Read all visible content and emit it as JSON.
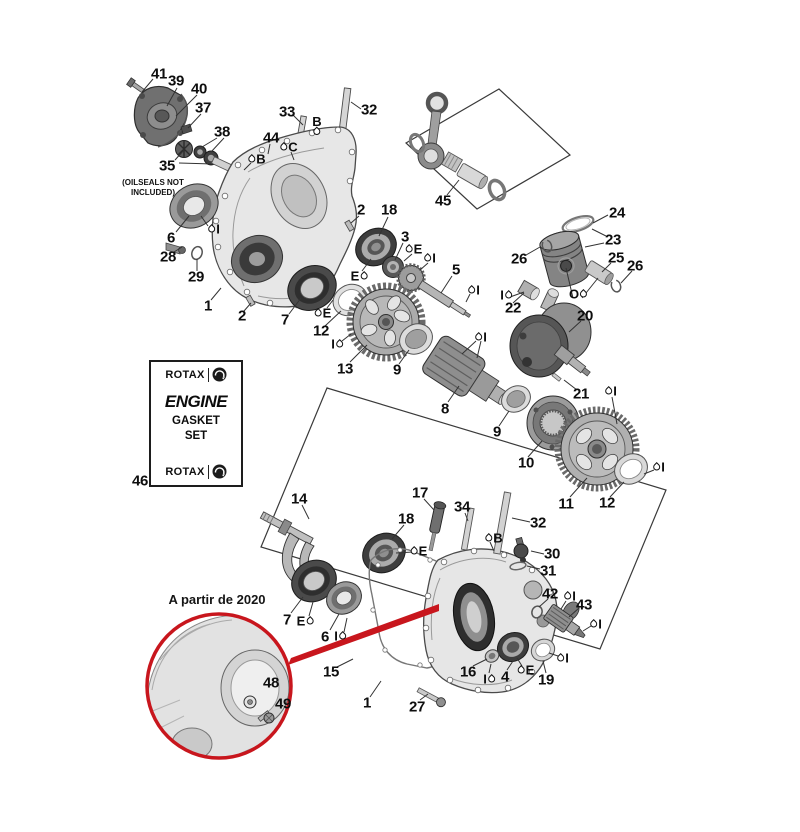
{
  "notes": {
    "oilseals_line1": "(OILSEALS NOT",
    "oilseals_line2": "INCLUDED)",
    "year_note": "A partir de 2020"
  },
  "gasket_kit": {
    "brand": "ROTAX",
    "product_line1": "ENGINE",
    "product_line2": "GASKET",
    "product_line3": "SET"
  },
  "colors": {
    "highlight_red": "#c8161d",
    "line": "#333333",
    "part_light": "#e6e6e6",
    "part_mid": "#9a9a9a",
    "part_dark": "#3d3d3d"
  },
  "part_labels": [
    {
      "n": "41",
      "x": 159,
      "y": 74
    },
    {
      "n": "39",
      "x": 176,
      "y": 81
    },
    {
      "n": "40",
      "x": 199,
      "y": 89
    },
    {
      "n": "37",
      "x": 203,
      "y": 108
    },
    {
      "n": "38",
      "x": 222,
      "y": 132
    },
    {
      "n": "33",
      "x": 287,
      "y": 112
    },
    {
      "n": "32",
      "x": 369,
      "y": 110
    },
    {
      "n": "44",
      "x": 271,
      "y": 138
    },
    {
      "n": "35",
      "x": 167,
      "y": 166
    },
    {
      "n": "6",
      "x": 171,
      "y": 238
    },
    {
      "n": "28",
      "x": 168,
      "y": 257
    },
    {
      "n": "29",
      "x": 196,
      "y": 277
    },
    {
      "n": "1",
      "x": 208,
      "y": 306
    },
    {
      "n": "2",
      "x": 361,
      "y": 210
    },
    {
      "n": "2",
      "x": 242,
      "y": 316
    },
    {
      "n": "18",
      "x": 389,
      "y": 210
    },
    {
      "n": "3",
      "x": 405,
      "y": 237
    },
    {
      "n": "45",
      "x": 443,
      "y": 201
    },
    {
      "n": "5",
      "x": 456,
      "y": 270
    },
    {
      "n": "24",
      "x": 617,
      "y": 213
    },
    {
      "n": "23",
      "x": 613,
      "y": 240
    },
    {
      "n": "26",
      "x": 519,
      "y": 259
    },
    {
      "n": "25",
      "x": 616,
      "y": 258
    },
    {
      "n": "26",
      "x": 635,
      "y": 266
    },
    {
      "n": "22",
      "x": 513,
      "y": 308
    },
    {
      "n": "20",
      "x": 585,
      "y": 316
    },
    {
      "n": "7",
      "x": 285,
      "y": 320
    },
    {
      "n": "12",
      "x": 321,
      "y": 331
    },
    {
      "n": "13",
      "x": 345,
      "y": 369
    },
    {
      "n": "9",
      "x": 397,
      "y": 370
    },
    {
      "n": "8",
      "x": 445,
      "y": 409
    },
    {
      "n": "9",
      "x": 497,
      "y": 432
    },
    {
      "n": "10",
      "x": 526,
      "y": 463
    },
    {
      "n": "21",
      "x": 581,
      "y": 394
    },
    {
      "n": "11",
      "x": 566,
      "y": 504
    },
    {
      "n": "12",
      "x": 607,
      "y": 503
    },
    {
      "n": "14",
      "x": 299,
      "y": 499
    },
    {
      "n": "17",
      "x": 420,
      "y": 493
    },
    {
      "n": "34",
      "x": 462,
      "y": 507
    },
    {
      "n": "32",
      "x": 538,
      "y": 523
    },
    {
      "n": "18",
      "x": 406,
      "y": 519
    },
    {
      "n": "30",
      "x": 552,
      "y": 554
    },
    {
      "n": "31",
      "x": 548,
      "y": 571
    },
    {
      "n": "42",
      "x": 550,
      "y": 594
    },
    {
      "n": "43",
      "x": 584,
      "y": 605
    },
    {
      "n": "7",
      "x": 287,
      "y": 620
    },
    {
      "n": "6",
      "x": 325,
      "y": 637
    },
    {
      "n": "15",
      "x": 331,
      "y": 672
    },
    {
      "n": "1",
      "x": 367,
      "y": 703
    },
    {
      "n": "27",
      "x": 417,
      "y": 707
    },
    {
      "n": "16",
      "x": 468,
      "y": 672
    },
    {
      "n": "4",
      "x": 505,
      "y": 677
    },
    {
      "n": "19",
      "x": 546,
      "y": 680
    },
    {
      "n": "46",
      "x": 140,
      "y": 481
    },
    {
      "n": "48",
      "x": 271,
      "y": 683
    },
    {
      "n": "49",
      "x": 283,
      "y": 704
    }
  ],
  "lube_marks": [
    {
      "letter": "B",
      "drop": "below",
      "x": 317,
      "y": 125
    },
    {
      "letter": "C",
      "drop": "left",
      "x": 289,
      "y": 147
    },
    {
      "letter": "B",
      "drop": "left",
      "x": 257,
      "y": 159
    },
    {
      "letter": "I",
      "drop": "left",
      "x": 214,
      "y": 229
    },
    {
      "letter": "E",
      "drop": "right",
      "x": 359,
      "y": 276
    },
    {
      "letter": "E",
      "drop": "left",
      "x": 414,
      "y": 249
    },
    {
      "letter": "I",
      "drop": "left",
      "x": 430,
      "y": 258
    },
    {
      "letter": "I",
      "drop": "left",
      "x": 474,
      "y": 290
    },
    {
      "letter": "I",
      "drop": "right",
      "x": 506,
      "y": 295
    },
    {
      "letter": "O",
      "drop": "right",
      "x": 578,
      "y": 294
    },
    {
      "letter": "E",
      "drop": "left",
      "x": 323,
      "y": 313
    },
    {
      "letter": "I",
      "drop": "right",
      "x": 337,
      "y": 344
    },
    {
      "letter": "I",
      "drop": "left",
      "x": 481,
      "y": 337
    },
    {
      "letter": "I",
      "drop": "left",
      "x": 611,
      "y": 391
    },
    {
      "letter": "I",
      "drop": "left",
      "x": 659,
      "y": 467
    },
    {
      "letter": "B",
      "drop": "left",
      "x": 494,
      "y": 538
    },
    {
      "letter": "E",
      "drop": "left",
      "x": 419,
      "y": 551
    },
    {
      "letter": "E",
      "drop": "right",
      "x": 305,
      "y": 621
    },
    {
      "letter": "I",
      "drop": "right",
      "x": 340,
      "y": 636
    },
    {
      "letter": "I",
      "drop": "right",
      "x": 489,
      "y": 679
    },
    {
      "letter": "E",
      "drop": "left",
      "x": 526,
      "y": 670
    },
    {
      "letter": "I",
      "drop": "left",
      "x": 563,
      "y": 658
    },
    {
      "letter": "I",
      "drop": "left",
      "x": 596,
      "y": 624
    },
    {
      "letter": "I",
      "drop": "left",
      "x": 570,
      "y": 596
    }
  ]
}
